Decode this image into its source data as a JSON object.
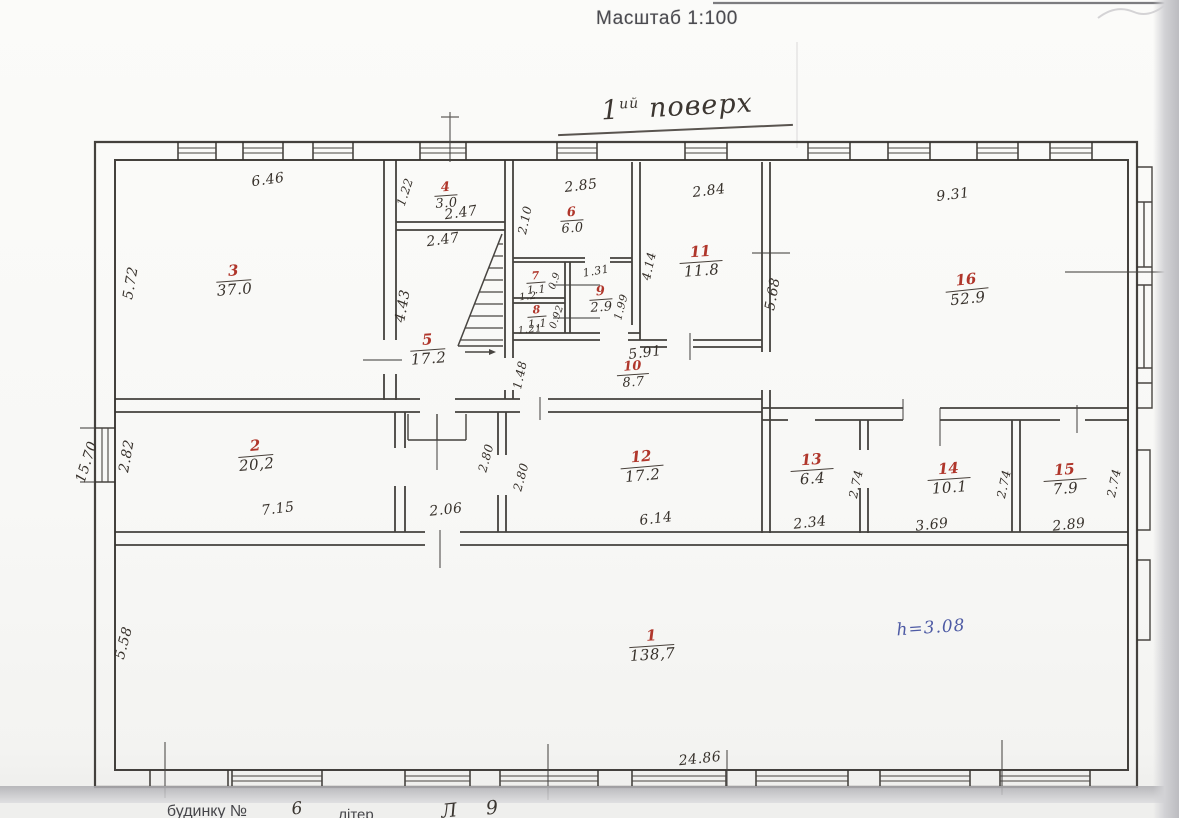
{
  "title": "Масштаб 1:100",
  "floor_label": {
    "prefix": "1",
    "sup": "ий",
    "word": "поверх"
  },
  "note_height": "h=3.08",
  "rooms": {
    "r1": {
      "num": "1",
      "area": "138,7"
    },
    "r2": {
      "num": "2",
      "area": "20,2"
    },
    "r3": {
      "num": "3",
      "area": "37.0"
    },
    "r4": {
      "num": "4",
      "area": "3.0"
    },
    "r5": {
      "num": "5",
      "area": "17.2"
    },
    "r6": {
      "num": "6",
      "area": "6.0"
    },
    "r7": {
      "num": "7",
      "area": "1.1"
    },
    "r8": {
      "num": "8",
      "area": "1.1"
    },
    "r9": {
      "num": "9",
      "area": "2.9"
    },
    "r10": {
      "num": "10",
      "area": "8.7"
    },
    "r11": {
      "num": "11",
      "area": "11.8"
    },
    "r12": {
      "num": "12",
      "area": "17.2"
    },
    "r13": {
      "num": "13",
      "area": "6.4"
    },
    "r14": {
      "num": "14",
      "area": "10.1"
    },
    "r15": {
      "num": "15",
      "area": "7.9"
    },
    "r16": {
      "num": "16",
      "area": "52.9"
    }
  },
  "dims": {
    "r3_w": "6.46",
    "r3_h": "5.72",
    "r4_h": "1.22",
    "r4_w": "2.47",
    "r5_w": "2.47",
    "r5_h": "4.43",
    "r6_w": "2.85",
    "r6_h": "2.10",
    "r7_w": "1.2",
    "r7_h": "0.9",
    "r8_w": "1.21",
    "r8_h": "0.92",
    "r9_w": "1.31",
    "r9_h": "1.99",
    "r10_w": "5.91",
    "r10_h": "1.48",
    "r11_w": "2.84",
    "r11_h": "4.14",
    "r12_w": "6.14",
    "r12_h": "2.80",
    "r13_w": "2.34",
    "r13_h": "2.74",
    "r14_w": "3.69",
    "r14_h": "2.74",
    "r15_w": "2.89",
    "r15_h": "2.74",
    "r16_w": "9.31",
    "r16_h": "5.68",
    "r2_w": "7.15",
    "r2_h": "2.82",
    "r1_w": "24.86",
    "r1_h": "5.58",
    "hall_w": "2.06",
    "hall_h": "2.80",
    "outside_left": "15.70"
  },
  "footer": {
    "building_label": "будинку №",
    "building_no": "6",
    "letter_label": "літер",
    "hand_a": "Л",
    "hand_b": "9"
  }
}
